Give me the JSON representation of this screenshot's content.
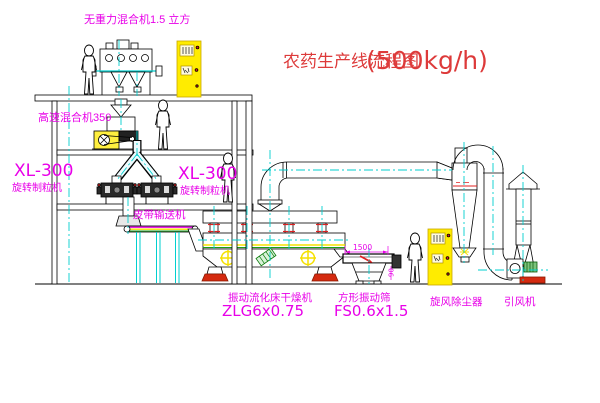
{
  "title": {
    "name": "农药生产线流程图",
    "capacity": "(500kg/h)"
  },
  "equipment_labels": {
    "gravity_mixer": "无重力混合机1.5 立方",
    "high_speed_mixer": "高速混合机350",
    "granulator_left_model": "XL-300",
    "granulator_left_name": "旋转制粒机",
    "granulator_mid_model": "XL-300",
    "granulator_mid_name": "旋转制粒机",
    "belt_conveyor": "皮带输送机",
    "fluid_bed_dryer_name": "振动流化床干燥机",
    "fluid_bed_dryer_model": "ZLG6x0.75",
    "square_screen_name": "方形振动筛",
    "square_screen_model": "FS0.6x1.5",
    "cyclone_name": "旋风除尘器",
    "fan_name": "引风机"
  },
  "dimensions": {
    "screen_length": "1500",
    "screen_height": "90"
  },
  "colors": {
    "label_magenta": "#e800e8",
    "title_red": "#dd3a3a",
    "centerline_cyan": "#00cfcf",
    "cabinet_yellow": "#ffec00",
    "accent_red": "#e02020",
    "motor_green": "#7cc47c",
    "stripe_yellow": "#f5e000"
  }
}
